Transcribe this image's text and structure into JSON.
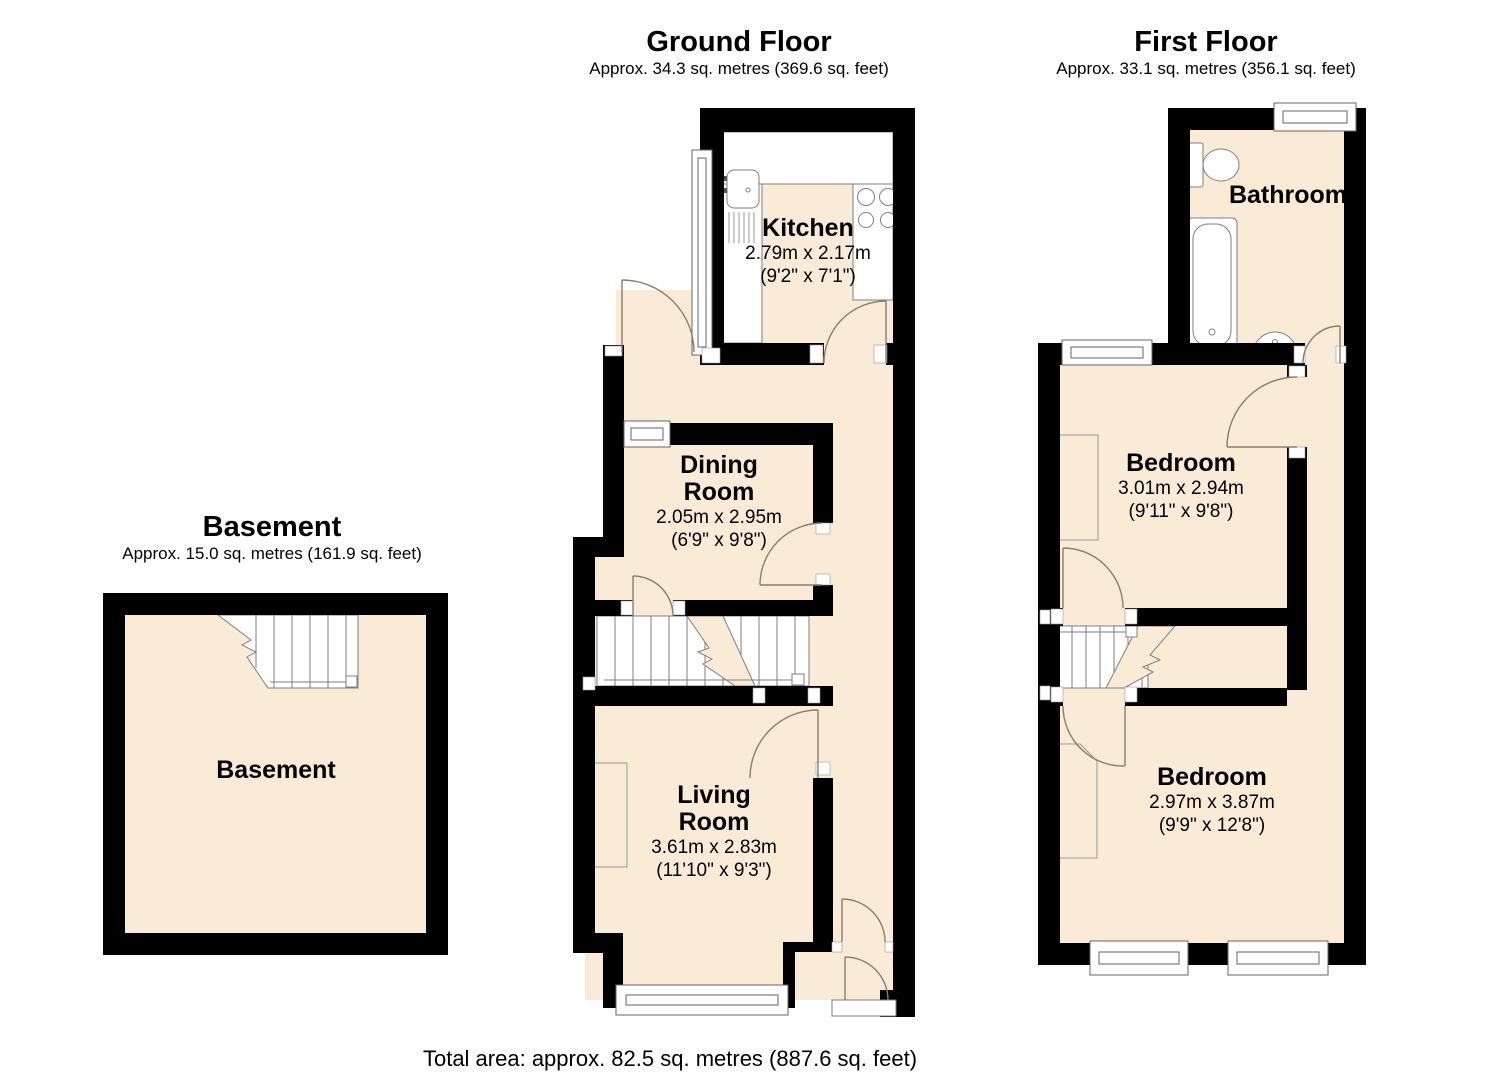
{
  "floors": {
    "ground": {
      "title": "Ground Floor",
      "subtitle": "Approx. 34.3 sq. metres (369.6 sq. feet)",
      "rooms": {
        "kitchen": {
          "name_lines": [
            "Kitchen"
          ],
          "dims_metric": "2.79m x 2.17m",
          "dims_imperial": "(9'2\" x 7'1\")"
        },
        "dining_room": {
          "name_lines": [
            "Dining",
            "Room"
          ],
          "dims_metric": "2.05m x 2.95m",
          "dims_imperial": "(6'9\" x 9'8\")"
        },
        "living_room": {
          "name_lines": [
            "Living",
            "Room"
          ],
          "dims_metric": "3.61m x 2.83m",
          "dims_imperial": "(11'10\" x 9'3\")"
        }
      }
    },
    "first": {
      "title": "First Floor",
      "subtitle": "Approx. 33.1 sq. metres (356.1 sq. feet)",
      "rooms": {
        "bathroom": {
          "name_lines": [
            "Bathroom"
          ]
        },
        "bedroom_rear": {
          "name_lines": [
            "Bedroom"
          ],
          "dims_metric": "3.01m x 2.94m",
          "dims_imperial": "(9'11\" x 9'8\")"
        },
        "bedroom_front": {
          "name_lines": [
            "Bedroom"
          ],
          "dims_metric": "2.97m x 3.87m",
          "dims_imperial": "(9'9\" x 12'8\")"
        }
      }
    },
    "basement": {
      "title": "Basement",
      "subtitle": "Approx. 15.0 sq. metres (161.9 sq. feet)",
      "rooms": {
        "basement": {
          "name_lines": [
            "Basement"
          ]
        }
      }
    }
  },
  "total_area_label": "Total area: approx. 82.5 sq. metres (887.6 sq. feet)",
  "colors": {
    "floor_fill": "#FAEBD7",
    "wall": "#000000",
    "door_arc": "#8B7D6B",
    "fixture_outline": "#7F7F7F",
    "window_outline": "#666666"
  }
}
